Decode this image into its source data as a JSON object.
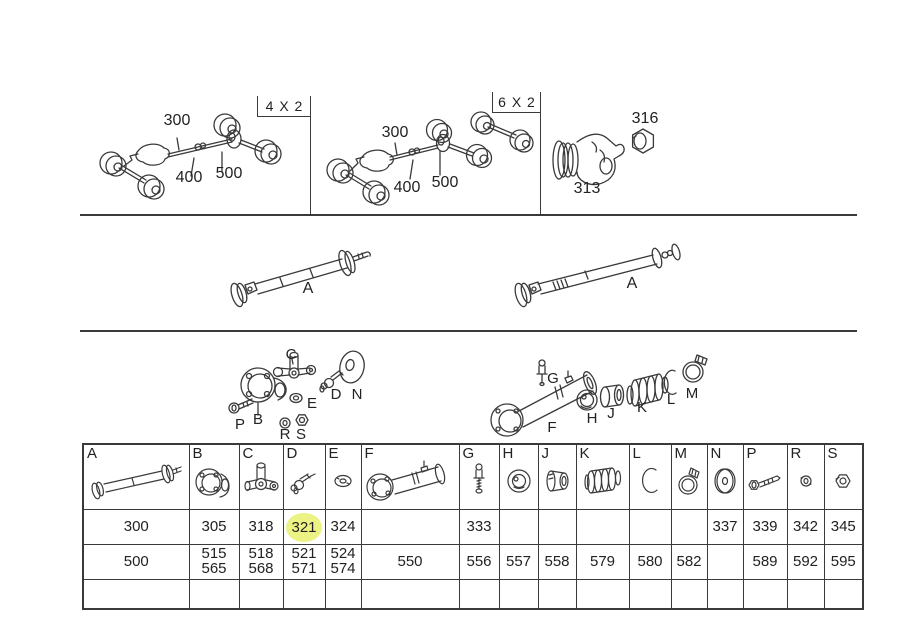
{
  "colors": {
    "background": "#ffffff",
    "line": "#3a3a3a",
    "text": "#222222",
    "highlight": "#edf285"
  },
  "panels": {
    "p4x2": {
      "tab": "4 X 2",
      "c300": "300",
      "c400": "400",
      "c500": "500"
    },
    "p6x2": {
      "tab": "6 X 2",
      "c300": "300",
      "c400": "400",
      "c500": "500"
    },
    "flange": {
      "yoke": "313",
      "nut": "316"
    }
  },
  "shafts": {
    "left": "A",
    "right": "A"
  },
  "exploded": {
    "C": "C",
    "E": "E",
    "D": "D",
    "N": "N",
    "P": "P",
    "B": "B",
    "R": "R",
    "S": "S",
    "G": "G",
    "F": "F",
    "H": "H",
    "J": "J",
    "K": "K",
    "L": "L",
    "M": "M"
  },
  "table": {
    "columns": [
      "A",
      "B",
      "C",
      "D",
      "E",
      "F",
      "G",
      "H",
      "J",
      "K",
      "L",
      "M",
      "N",
      "P",
      "R",
      "S"
    ],
    "icons": [
      "propeller-shaft-icon",
      "flange-yoke-icon",
      "universal-joint-icon",
      "grease-nipple-angled-icon",
      "seal-fitting-icon",
      "slip-joint-icon",
      "grease-nipple-icon",
      "bearing-icon",
      "bushing-icon",
      "boot-icon",
      "snap-ring-icon",
      "hose-clamp-icon",
      "washer-icon",
      "bolt-icon",
      "locknut-icon",
      "nut-icon"
    ],
    "rows": [
      {
        "cells": [
          "300",
          "305",
          "318",
          "321",
          "324",
          "",
          "333",
          "",
          "",
          "",
          "",
          "",
          "337",
          "339",
          "342",
          "345"
        ],
        "highlighted_cell": 3
      },
      {
        "cells": [
          "500",
          "515\n565",
          "518\n568",
          "521\n571",
          "524\n574",
          "550",
          "556",
          "557",
          "558",
          "579",
          "580",
          "582",
          "",
          "589",
          "592",
          "595"
        ],
        "highlighted_cell": -1
      },
      {
        "cells": [
          "",
          "",
          "",
          "",
          "",
          "",
          "",
          "",
          "",
          "",
          "",
          "",
          "",
          "",
          "",
          ""
        ],
        "highlighted_cell": -1
      }
    ]
  }
}
